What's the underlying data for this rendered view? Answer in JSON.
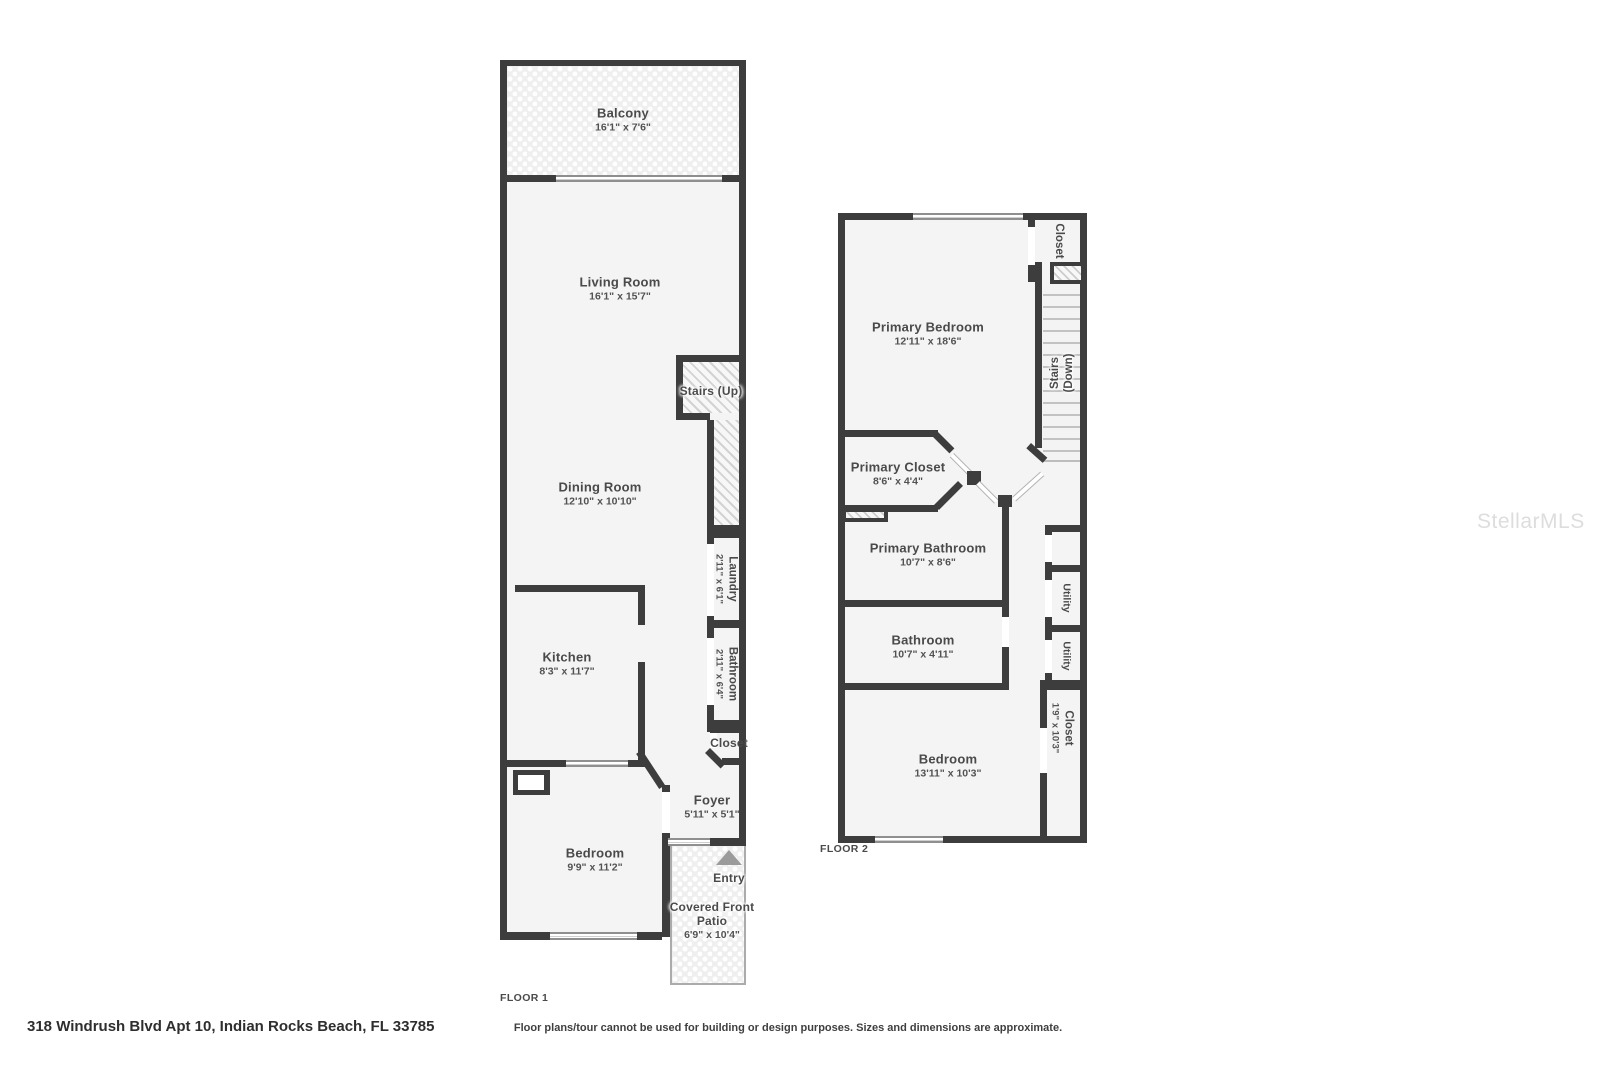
{
  "address": "318 Windrush Blvd Apt 10, Indian Rocks Beach, FL 33785",
  "disclaimer": "Floor plans/tour cannot be used for building or design purposes. Sizes and dimensions are approximate.",
  "watermark": "StellarMLS",
  "colors": {
    "wall": "#3d3d3d",
    "room_fill": "#f4f4f4",
    "label": "#4a4a4a"
  },
  "floor1": {
    "label": "FLOOR 1",
    "rooms": {
      "balcony": {
        "name": "Balcony",
        "dims": "16'1\" x 7'6\""
      },
      "living_room": {
        "name": "Living Room",
        "dims": "16'1\" x 15'7\""
      },
      "stairs": {
        "name": "Stairs (Up)"
      },
      "dining_room": {
        "name": "Dining Room",
        "dims": "12'10\" x 10'10\""
      },
      "laundry": {
        "name": "Laundry",
        "dims": "2'11\" x 6'1\""
      },
      "kitchen": {
        "name": "Kitchen",
        "dims": "8'3\" x 11'7\""
      },
      "bathroom": {
        "name": "Bathroom",
        "dims": "2'11\" x 6'4\""
      },
      "closet": {
        "name": "Closet"
      },
      "foyer": {
        "name": "Foyer",
        "dims": "5'11\" x 5'1\""
      },
      "bedroom": {
        "name": "Bedroom",
        "dims": "9'9\" x 11'2\""
      },
      "entry": {
        "name": "Entry"
      },
      "covered_front_patio": {
        "name": "Covered Front Patio",
        "dims": "6'9\" x 10'4\""
      }
    }
  },
  "floor2": {
    "label": "FLOOR 2",
    "rooms": {
      "closet_top": {
        "name": "Closet"
      },
      "primary_bedroom": {
        "name": "Primary Bedroom",
        "dims": "12'11\" x 18'6\""
      },
      "stairs": {
        "name": "Stairs",
        "sub": "(Down)"
      },
      "primary_closet": {
        "name": "Primary Closet",
        "dims": "8'6\" x 4'4\""
      },
      "primary_bathroom": {
        "name": "Primary Bathroom",
        "dims": "10'7\" x 8'6\""
      },
      "utility_a": {
        "name": "Utility"
      },
      "utility_b": {
        "name": "Utility"
      },
      "bathroom": {
        "name": "Bathroom",
        "dims": "10'7\" x 4'11\""
      },
      "closet_right": {
        "name": "Closet",
        "dims": "1'9\" x 10'3\""
      },
      "bedroom": {
        "name": "Bedroom",
        "dims": "13'11\" x 10'3\""
      }
    }
  }
}
